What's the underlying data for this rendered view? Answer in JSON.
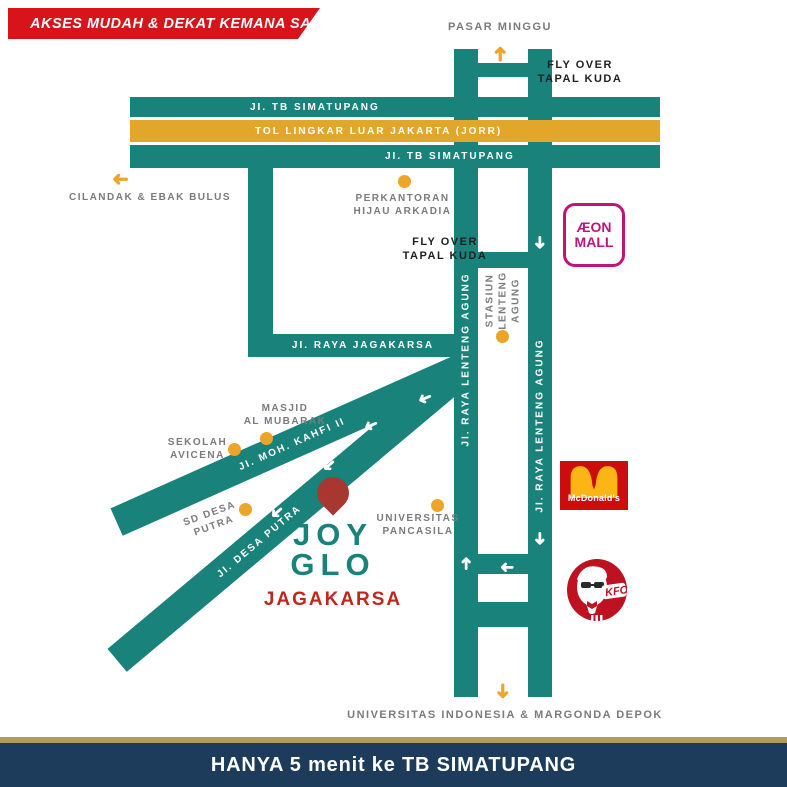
{
  "banner": {
    "text": "AKSES MUDAH & DEKAT KEMANA SAJA"
  },
  "destinations": {
    "pasar_minggu": "PASAR MINGGU",
    "cilandak": "CILANDAK & EBAK BULUS",
    "ui_depok": "UNIVERSITAS INDONESIA & MARGONDA DEPOK"
  },
  "flyover": {
    "top": "FLY OVER\nTAPAL KUDA",
    "mid": "FLY OVER\nTAPAL KUDA"
  },
  "roads": {
    "tb_simatupang_top": "JI. TB SIMATUPANG",
    "jorr": "TOL LINGKAR LUAR JAKARTA (JORR)",
    "tb_simatupang_bottom": "JI. TB SIMATUPANG",
    "jagakarsa": "JI. RAYA JAGAKARSA",
    "lenteng_left": "JI. RAYA LENTENG AGUNG",
    "lenteng_right": "JI. RAYA LENTENG AGUNG",
    "kahfi": "JI. MOH. KAHFI II",
    "desa_putra": "JI. DESA PUTRA"
  },
  "pois": {
    "perkantoran": "PERKANTORAN\nHIJAU ARKADIA",
    "stasiun": "STASIUN\nLENTENG\nAGUNG",
    "masjid": "MASJID\nAL MUBARAK",
    "sekolah": "SEKOLAH\nAVICENA",
    "sd_desa_putra": "SD DESA\nPUTRA",
    "univ_pancasila": "UNIVERSITAS\nPANCASILA"
  },
  "property": {
    "line1": "JOY",
    "line2": "GLO",
    "area": "JAGAKARSA"
  },
  "logos": {
    "aeon_line1": "ÆON",
    "aeon_line2": "MALL",
    "mcd": "McDonald's",
    "kfc": "KFC"
  },
  "footer": {
    "text": "HANYA 5 menit ke TB SIMATUPANG"
  },
  "icons": {
    "arrow": "➜"
  },
  "colors": {
    "road_teal": "#19837b",
    "toll_yellow": "#e2a62b",
    "accent_orange": "#eda428",
    "banner_red": "#d7141a",
    "pin_red": "#a83731",
    "navy": "#1d3c5b",
    "gold": "#b29a5b",
    "aeon_magenta": "#c0137c"
  }
}
